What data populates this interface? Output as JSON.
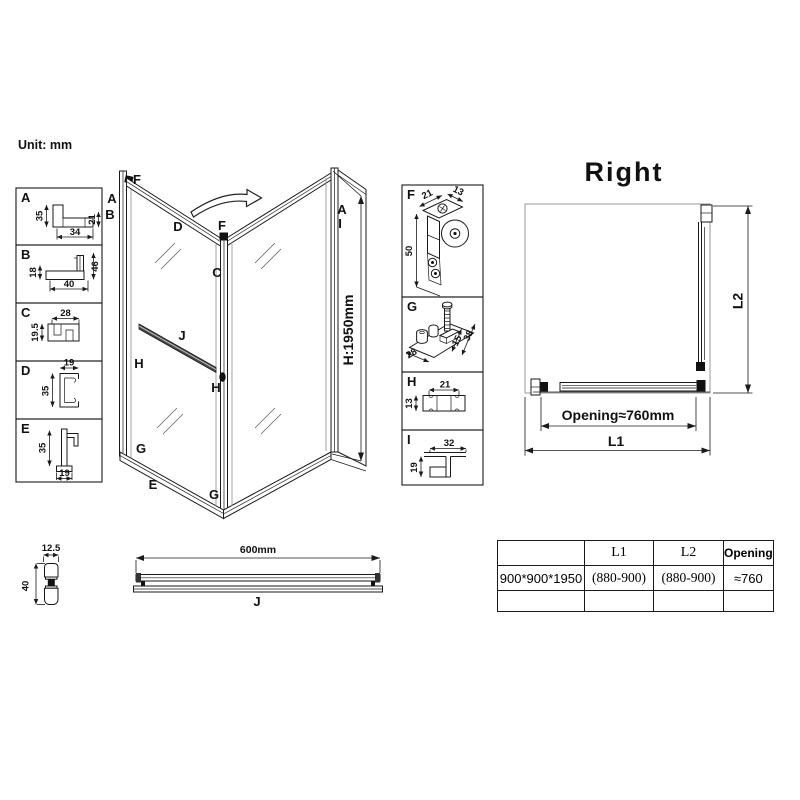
{
  "unit_label": "Unit: mm",
  "main": {
    "labels": {
      "f_top": "F",
      "a_left": "A",
      "b_left": "B",
      "d_rail": "D",
      "f_mid": "F",
      "c_post": "C",
      "j_bar": "J",
      "h_left": "H",
      "h_mid": "H",
      "g_left": "G",
      "e_rail": "E",
      "g_mid": "G",
      "a_right": "A",
      "i_right": "I",
      "height": "H:1950mm"
    }
  },
  "details_left": [
    {
      "id": "A",
      "dims": [
        "35",
        "21",
        "34"
      ]
    },
    {
      "id": "B",
      "dims": [
        "18",
        "46",
        "40"
      ]
    },
    {
      "id": "C",
      "dims": [
        "28",
        "19.5"
      ]
    },
    {
      "id": "D",
      "dims": [
        "19",
        "35"
      ]
    },
    {
      "id": "E",
      "dims": [
        "35",
        "19"
      ]
    }
  ],
  "details_right": [
    {
      "id": "F",
      "dims": [
        "21",
        "13",
        "50"
      ]
    },
    {
      "id": "G",
      "dims": [
        "28",
        "15",
        "38"
      ]
    },
    {
      "id": "H",
      "dims": [
        "21",
        "13"
      ]
    },
    {
      "id": "I",
      "dims": [
        "32",
        "19"
      ]
    }
  ],
  "plan": {
    "title": "Right",
    "opening": "Opening≈760mm",
    "l1": "L1",
    "l2": "L2"
  },
  "towel_bar": {
    "length": "600mm",
    "label": "J"
  },
  "knob": {
    "width": "12.5",
    "height": "40"
  },
  "spec_table": {
    "headers": [
      "",
      "L1",
      "L2",
      "Opening"
    ],
    "rows": [
      [
        "900*900*1950",
        "(880-900)",
        "(880-900)",
        "≈760"
      ],
      [
        "",
        "",
        "",
        ""
      ]
    ]
  }
}
